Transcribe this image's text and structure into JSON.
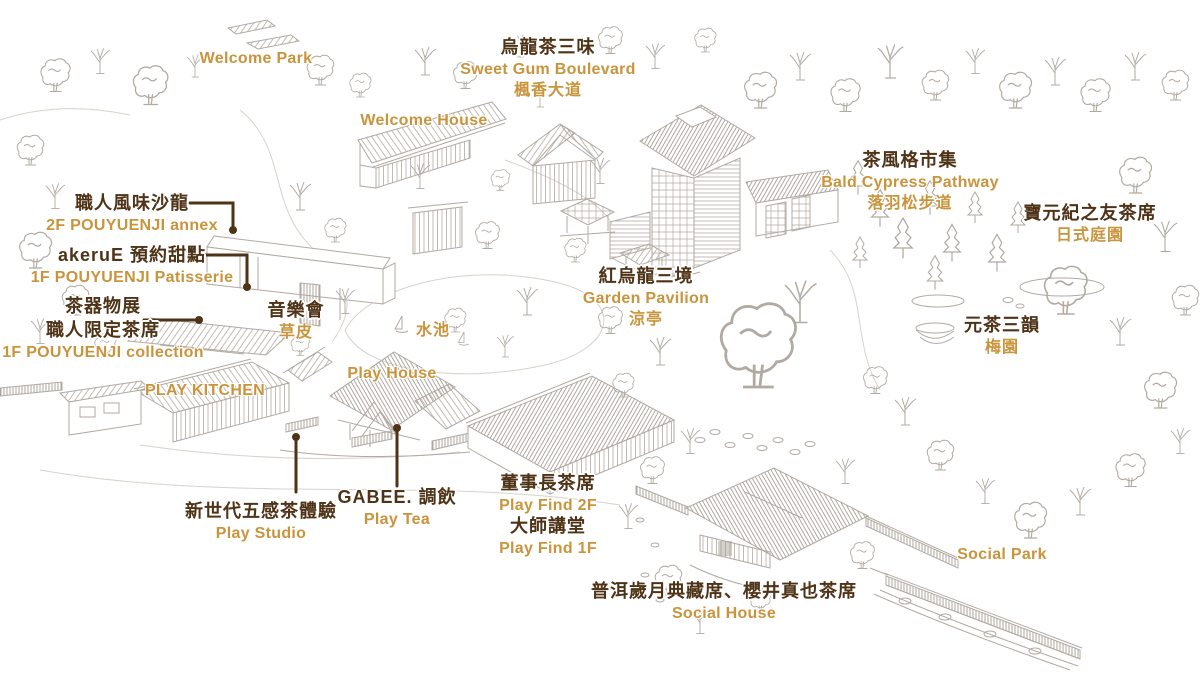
{
  "palette": {
    "dark_brown": "#4e3317",
    "gold": "#c9943c",
    "sketch_line": "#b2aaa1"
  },
  "labels": {
    "welcome_park": {
      "en": "Welcome Park"
    },
    "sweet_gum_boulevard": {
      "zh": "烏龍茶三味",
      "en": "Sweet Gum Boulevard",
      "zh_sub": "楓香大道"
    },
    "welcome_house": {
      "en": "Welcome House"
    },
    "bald_cypress_pathway": {
      "zh": "茶風格市集",
      "en": "Bald Cypress Pathway",
      "zh_sub": "落羽松步道"
    },
    "japanese_garden": {
      "zh": "寶元紀之友茶席",
      "zh_sub": "日式庭園"
    },
    "annex": {
      "zh": "職人風味沙龍",
      "en": "2F POUYUENJI annex"
    },
    "patisserie": {
      "zh": "akeruE 預約甜點",
      "en": "1F POUYUENJI Patisserie"
    },
    "collection": {
      "zh": "茶器物展",
      "zh2": "職人限定茶席",
      "en": "1F POUYUENJI collection"
    },
    "concert_lawn": {
      "zh": "音樂會",
      "zh_sub": "草皮"
    },
    "garden_pavilion": {
      "zh": "紅烏龍三境",
      "en": "Garden Pavilion",
      "zh_sub": "涼亭"
    },
    "pond": {
      "zh": "水池"
    },
    "play_house": {
      "en": "Play House"
    },
    "play_kitchen": {
      "en": "PLAY KITCHEN"
    },
    "play_studio": {
      "zh": "新世代五感茶體驗",
      "en": "Play Studio"
    },
    "play_tea": {
      "zh": "GABEE. 調飲",
      "en": "Play Tea"
    },
    "play_find_2f": {
      "zh": "董事長茶席",
      "en": "Play Find 2F"
    },
    "play_find_1f": {
      "zh": "大師講堂",
      "en": "Play Find 1F"
    },
    "social_house": {
      "zh": "普洱歲月典藏席、櫻井真也茶席",
      "en": "Social House"
    },
    "social_park": {
      "en": "Social Park"
    },
    "plum_garden": {
      "zh": "元茶三韻",
      "zh_sub": "梅園"
    }
  }
}
